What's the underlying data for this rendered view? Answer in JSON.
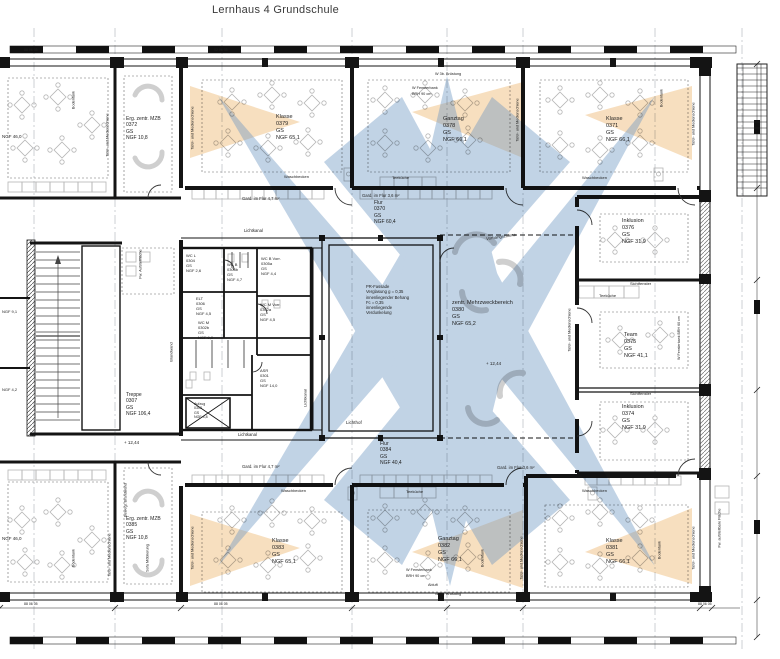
{
  "title": "Lernhaus 4 Grundschule",
  "colors": {
    "beam_blue": "#6d96c2",
    "cone_orange": "#f0c48a",
    "wall": "#141414",
    "furniture": "#b5b5b5"
  },
  "facade_note": {
    "x": 366,
    "y": 284,
    "size": 4.2,
    "lines": [
      "PR-Fassade",
      "Verglasung g = 0,35",
      "innenliegender Behang",
      "Fc = 0,35",
      "innenliegende",
      "Verdunkelung"
    ]
  },
  "levels": [
    {
      "text": "+ 12,44",
      "x": 486,
      "y": 361
    },
    {
      "text": "+ 12,44",
      "x": 124,
      "y": 440
    }
  ],
  "rooms": [
    {
      "id": "klasse-top-mid",
      "name": "Klasse",
      "number": "0379",
      "lvl": "GS",
      "area": "NGF 65,1",
      "x": 276,
      "y": 114,
      "size": 5.5
    },
    {
      "id": "ganztag-top",
      "name": "Ganztag",
      "number": "0378",
      "lvl": "GS",
      "area": "NGF 66,1",
      "x": 443,
      "y": 116,
      "size": 5.5
    },
    {
      "id": "klasse-top-right",
      "name": "Klasse",
      "number": "0371",
      "lvl": "GS",
      "area": "NGF 66,1",
      "x": 606,
      "y": 116,
      "size": 5.5
    },
    {
      "id": "erg-mzb-top",
      "name": "Erg. zentr. MZB",
      "number": "0372",
      "lvl": "GS",
      "area": "NGF 10,8",
      "x": 126,
      "y": 116,
      "size": 5
    },
    {
      "id": "inklusion-top",
      "name": "Inklusion",
      "number": "0376",
      "lvl": "GS",
      "area": "NGF 31,9",
      "x": 622,
      "y": 218,
      "size": 5.5
    },
    {
      "id": "team",
      "name": "Team",
      "number": "0375",
      "lvl": "GS",
      "area": "NGF 41,1",
      "x": 624,
      "y": 332,
      "size": 5.5
    },
    {
      "id": "inklusion-bottom",
      "name": "Inklusion",
      "number": "0374",
      "lvl": "GS",
      "area": "NGF 31,9",
      "x": 622,
      "y": 404,
      "size": 5.5
    },
    {
      "id": "mehrzweckbereich",
      "name": "zentr. Mehrzweckbereich",
      "number": "0380",
      "lvl": "GS",
      "area": "NGF 65,2",
      "x": 452,
      "y": 300,
      "size": 5.5
    },
    {
      "id": "flur-top",
      "name": "Flur",
      "number": "0370",
      "lvl": "GS",
      "area": "NGF 60,4",
      "x": 374,
      "y": 200,
      "size": 5
    },
    {
      "id": "flur-bottom",
      "name": "Flur",
      "number": "0384",
      "lvl": "GS",
      "area": "NGF 40,4",
      "x": 380,
      "y": 441,
      "size": 5
    },
    {
      "id": "klasse-bottom-mid",
      "name": "Klasse",
      "number": "0383",
      "lvl": "GS",
      "area": "NGF 65,1",
      "x": 272,
      "y": 538,
      "size": 5.5
    },
    {
      "id": "ganztag-bottom",
      "name": "Ganztag",
      "number": "0382",
      "lvl": "GS",
      "area": "NGF 66,1",
      "x": 438,
      "y": 536,
      "size": 5.5
    },
    {
      "id": "klasse-bottom-right",
      "name": "Klasse",
      "number": "0381",
      "lvl": "GS",
      "area": "NGF 66,1",
      "x": 606,
      "y": 538,
      "size": 5.5
    },
    {
      "id": "erg-mzb-bottom",
      "name": "Erg. zentr. MZB",
      "number": "0385",
      "lvl": "GS",
      "area": "NGF 10,8",
      "x": 126,
      "y": 516,
      "size": 5
    },
    {
      "id": "wc-l",
      "name": "WC L",
      "number": "0304",
      "lvl": "GS",
      "area": "NGF 2,6",
      "x": 186,
      "y": 253,
      "size": 4
    },
    {
      "id": "wc-b",
      "name": "WC B",
      "number": "0305b",
      "lvl": "GS",
      "area": "NGF 4,7",
      "x": 227,
      "y": 262,
      "size": 4
    },
    {
      "id": "wc-b-vorr",
      "name": "WC B Vorr.",
      "number": "0305a",
      "lvl": "GS",
      "area": "NGF 4,4",
      "x": 261,
      "y": 256,
      "size": 4
    },
    {
      "id": "elt",
      "name": "ELT",
      "number": "0306",
      "lvl": "GS",
      "area": "NGF 4,5",
      "x": 196,
      "y": 296,
      "size": 4
    },
    {
      "id": "wc-m",
      "name": "WC M",
      "number": "0302b",
      "lvl": "GS",
      "area": "NGF 9,0",
      "x": 198,
      "y": 320,
      "size": 4
    },
    {
      "id": "wc-m-vorr",
      "name": "WC M Vorr.",
      "number": "0302a",
      "lvl": "GS",
      "area": "NGF 4,5",
      "x": 260,
      "y": 302,
      "size": 4
    },
    {
      "id": "asr",
      "name": "ASR",
      "number": "0301",
      "lvl": "GS",
      "area": "NGF 14,0",
      "x": 260,
      "y": 368,
      "size": 4
    },
    {
      "id": "aufzug",
      "name": "Aufzug",
      "number": "0303",
      "lvl": "GS",
      "area": "NGF 4,8",
      "x": 194,
      "y": 402,
      "size": 3.6
    },
    {
      "id": "treppe",
      "name": "Treppe",
      "number": "0307",
      "lvl": "GS",
      "area": "NGF 106,4",
      "x": 126,
      "y": 392,
      "size": 5
    }
  ],
  "annotations": [
    {
      "text": "Lichtkanal",
      "x": 244,
      "y": 228,
      "size": 4.2
    },
    {
      "text": "Lichtkanal",
      "x": 238,
      "y": 432,
      "size": 4.2
    },
    {
      "text": "Lichtkanal",
      "x": 306,
      "y": 398,
      "rot": -90,
      "size": 4
    },
    {
      "text": "Lichthof",
      "x": 346,
      "y": 420,
      "size": 4.5
    },
    {
      "text": "Vorhangschiene",
      "x": 486,
      "y": 234,
      "tilt": true,
      "size": 4.2
    },
    {
      "text": "Gard. im Flur 4,7 m²",
      "x": 242,
      "y": 196,
      "size": 4.2
    },
    {
      "text": "Gard. im Flur 3,6 m²",
      "x": 362,
      "y": 193,
      "size": 4.2
    },
    {
      "text": "Gard. im Flur 4,7 m²",
      "x": 242,
      "y": 464,
      "size": 4.2
    },
    {
      "text": "Gard. im Flur 3,6 m²",
      "x": 497,
      "y": 465,
      "size": 4.2
    },
    {
      "text": "Waschbecken",
      "x": 284,
      "y": 175,
      "size": 4
    },
    {
      "text": "Waschbecken",
      "x": 582,
      "y": 176,
      "size": 4
    },
    {
      "text": "Waschbecken",
      "x": 281,
      "y": 489,
      "size": 4
    },
    {
      "text": "Waschbecken",
      "x": 582,
      "y": 489,
      "size": 4
    },
    {
      "text": "Teeküche",
      "x": 392,
      "y": 176,
      "size": 4
    },
    {
      "text": "Teeküche",
      "x": 599,
      "y": 294,
      "size": 4
    },
    {
      "text": "Teeküche",
      "x": 406,
      "y": 490,
      "size": 4
    },
    {
      "text": "Tafel- und Medienschiene",
      "x": 193,
      "y": 128,
      "rot": -90,
      "size": 3.8
    },
    {
      "text": "Tafel- und Medienschiene",
      "x": 108,
      "y": 135,
      "rot": -90,
      "size": 3.8
    },
    {
      "text": "Tafel- und Medienschiene",
      "x": 518,
      "y": 120,
      "rot": -90,
      "size": 3.8
    },
    {
      "text": "Tafel- und Medienschiene",
      "x": 694,
      "y": 124,
      "rot": -90,
      "size": 3.8
    },
    {
      "text": "Tafel- und Medienschiene",
      "x": 570,
      "y": 330,
      "rot": -90,
      "size": 3.8
    },
    {
      "text": "Tafel- und Medienschiene",
      "x": 522,
      "y": 558,
      "rot": -90,
      "size": 3.8
    },
    {
      "text": "Tafel- und Medienschiene",
      "x": 694,
      "y": 548,
      "rot": -90,
      "size": 3.8
    },
    {
      "text": "Tafel- und Medienschiene",
      "x": 193,
      "y": 548,
      "rot": -90,
      "size": 3.8
    },
    {
      "text": "Tafel- und Medienschiene",
      "x": 110,
      "y": 555,
      "rot": -90,
      "size": 3.8
    },
    {
      "text": "Bodentank",
      "x": 74,
      "y": 100,
      "rot": -90,
      "size": 3.8
    },
    {
      "text": "Bodentank",
      "x": 662,
      "y": 98,
      "rot": -90,
      "size": 3.8
    },
    {
      "text": "Bodentank",
      "x": 483,
      "y": 558,
      "rot": -90,
      "size": 3.8
    },
    {
      "text": "Bodentank",
      "x": 660,
      "y": 550,
      "rot": -90,
      "size": 3.8
    },
    {
      "text": "Bodentank",
      "x": 74,
      "y": 558,
      "rot": -90,
      "size": 3.8
    },
    {
      "text": "W 3b. Brüstung",
      "x": 435,
      "y": 72,
      "size": 3.8
    },
    {
      "text": "W Fensterbank",
      "x": 412,
      "y": 86,
      "size": 3.8
    },
    {
      "text": "BRH 90 cm",
      "x": 412,
      "y": 92,
      "size": 3.8
    },
    {
      "text": "W 3b. Brüstung",
      "x": 435,
      "y": 592,
      "size": 3.8
    },
    {
      "text": "W Fensterbank",
      "x": 406,
      "y": 568,
      "size": 3.8
    },
    {
      "text": "BRH 90 cm",
      "x": 406,
      "y": 574,
      "size": 3.8
    },
    {
      "text": "Abluft",
      "x": 428,
      "y": 583,
      "size": 3.8
    },
    {
      "text": "W Fensterbank BRH 60 cm",
      "x": 679,
      "y": 338,
      "rot": -90,
      "size": 3.6
    },
    {
      "text": "Sichtfenster",
      "x": 630,
      "y": 282,
      "size": 4
    },
    {
      "text": "Sichtfenster",
      "x": 630,
      "y": 392,
      "size": 4
    },
    {
      "text": "Sofa Möblierung",
      "x": 148,
      "y": 558,
      "rot": -90,
      "size": 3.8
    },
    {
      "text": "Bewegl. Brandwand",
      "x": 126,
      "y": 500,
      "rot": -90,
      "size": 3.8
    },
    {
      "text": "Brandwand",
      "x": 172,
      "y": 352,
      "rot": -90,
      "size": 3.8
    },
    {
      "text": "Fw. Aufstellfläche",
      "x": 141,
      "y": 264,
      "rot": -90,
      "size": 3.8
    },
    {
      "text": "Fw. aufstellbare Fläche",
      "x": 720,
      "y": 528,
      "rot": -90,
      "size": 3.8
    },
    {
      "text": "NGF 46,0",
      "x": 2,
      "y": 134,
      "size": 4.5
    },
    {
      "text": "NGF 46,0",
      "x": 2,
      "y": 536,
      "size": 4.5
    },
    {
      "text": "NGF 9,1",
      "x": 2,
      "y": 310,
      "size": 4
    },
    {
      "text": "NGF 4,2",
      "x": 2,
      "y": 388,
      "size": 4
    },
    {
      "text": "02 06 05",
      "x": 214,
      "y": 48,
      "size": 3.5
    },
    {
      "text": "88 06 05",
      "x": 24,
      "y": 48,
      "size": 3.5
    },
    {
      "text": "88 06 05",
      "x": 24,
      "y": 602,
      "size": 3.5
    },
    {
      "text": "88 06 05",
      "x": 214,
      "y": 602,
      "size": 3.5
    },
    {
      "text": "88 06 05",
      "x": 698,
      "y": 602,
      "size": 3.5
    }
  ]
}
